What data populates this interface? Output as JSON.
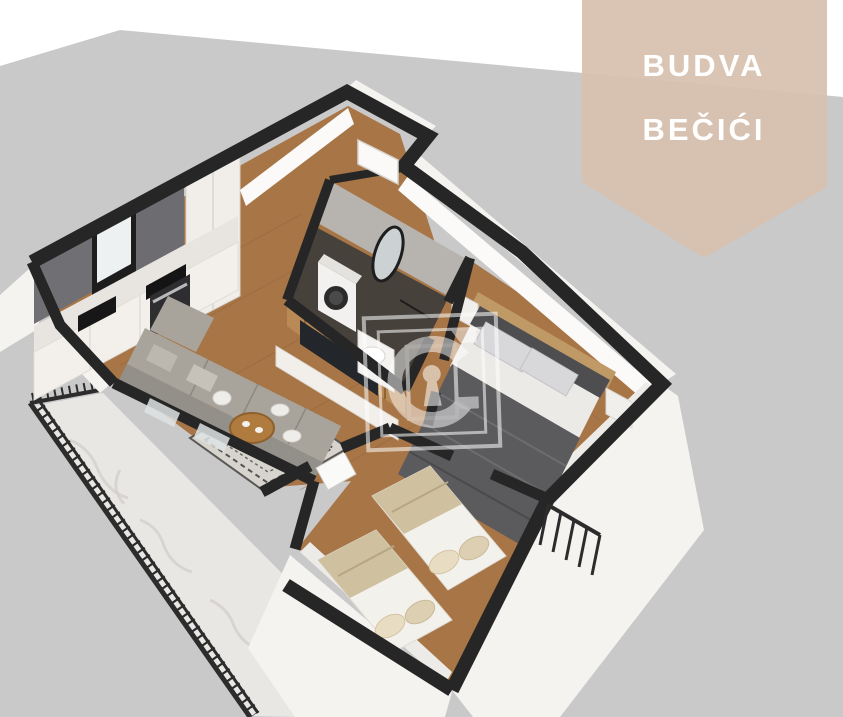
{
  "banner": {
    "line1": "BUDVA",
    "line2": "BEČIĆI"
  },
  "watermark": {
    "icon": "c-keyhole-logo"
  },
  "colors": {
    "page_bg": "#ffffff",
    "backdrop": "#c9c9ca",
    "banner_bg": "#d8c1af",
    "banner_text": "#ffffff",
    "wall_top": "#262626",
    "wall_face": "#f5f3f0",
    "wood_floor": "#a87546",
    "marble_floor": "#e9e7e4",
    "bath_wall": "#b7b4b0",
    "bath_floor": "#46413b",
    "sofa_gray": "#a8a49c",
    "bed_duvet_gray": "#5b5b5e",
    "bed_blanket_tan": "#cfc0a0",
    "railing_dark": "#2c2c2c",
    "watermark_white": "#ffffff"
  }
}
